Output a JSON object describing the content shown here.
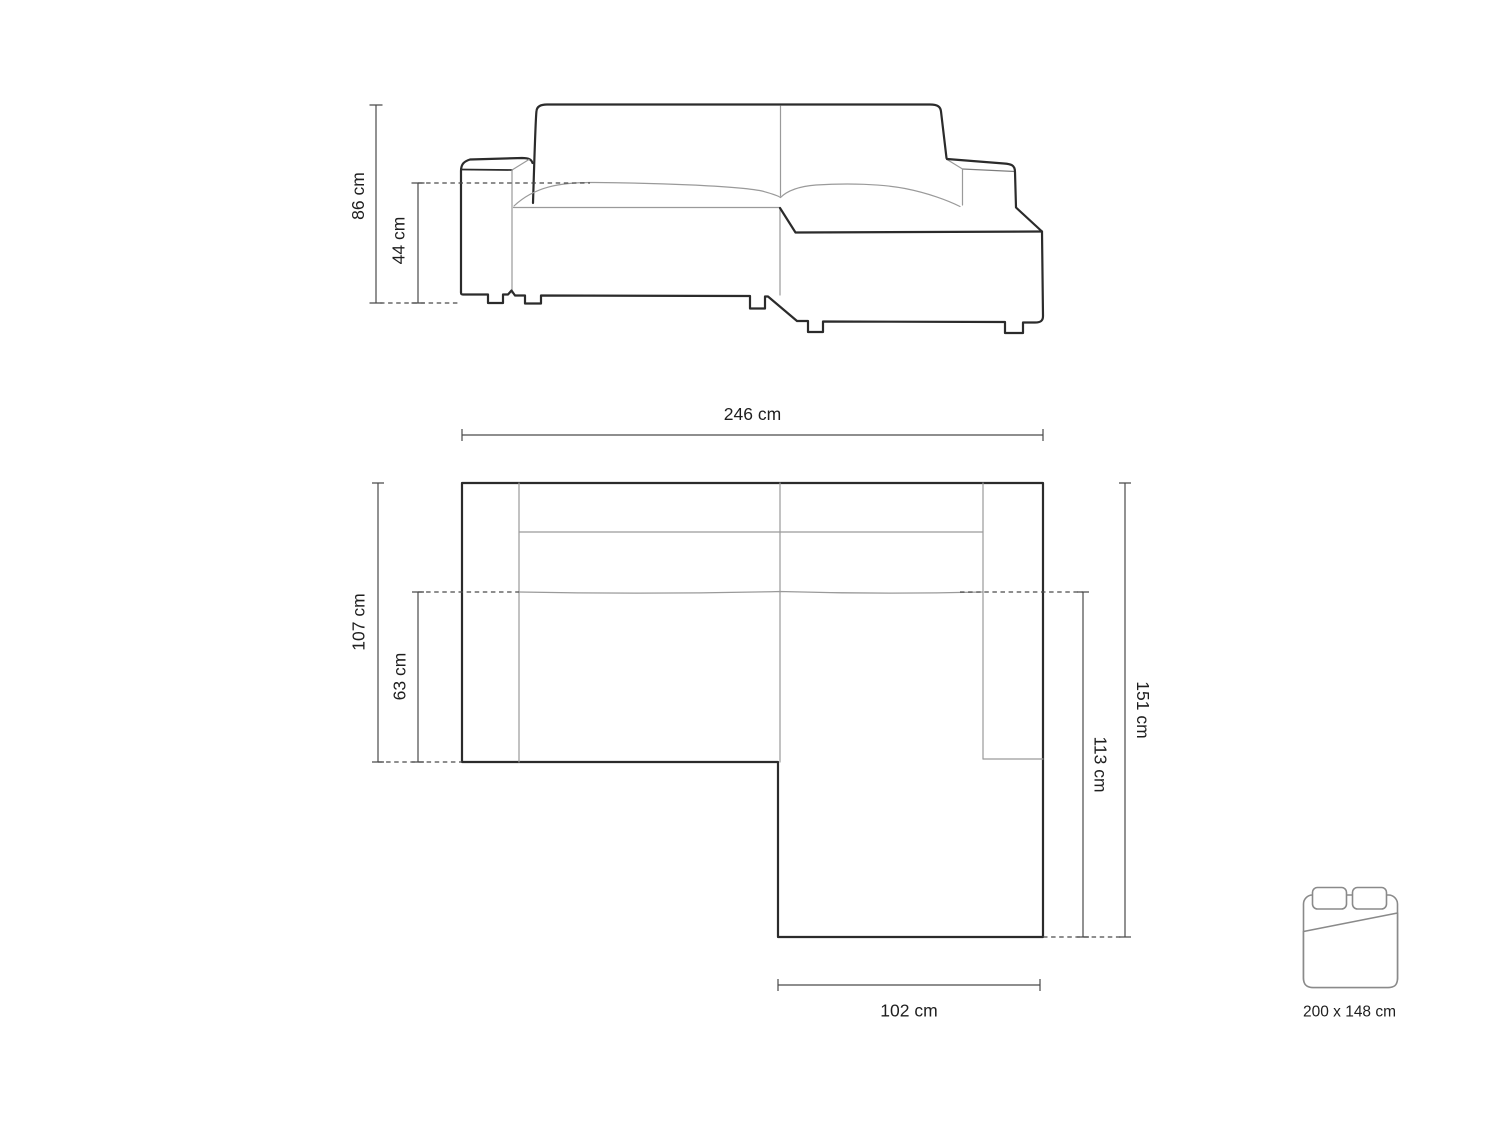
{
  "front_view": {
    "overall_height_label": "86 cm",
    "seat_height_label": "44 cm"
  },
  "top_view": {
    "overall_width_label": "246 cm",
    "overall_depth_label": "107 cm",
    "seat_depth_label": "63 cm",
    "right_length_label": "151 cm",
    "chaise_length_label": "113 cm",
    "chaise_width_label": "102 cm"
  },
  "sleeping_area": {
    "size_label": "200 x 148 cm"
  },
  "colors": {
    "outline": "#2b2b2b",
    "seam": "#9a9a9a",
    "dimension": "#4a4a4a",
    "text": "#1f1f1f",
    "bed_icon": "#8a8a8a",
    "background": "#ffffff"
  }
}
